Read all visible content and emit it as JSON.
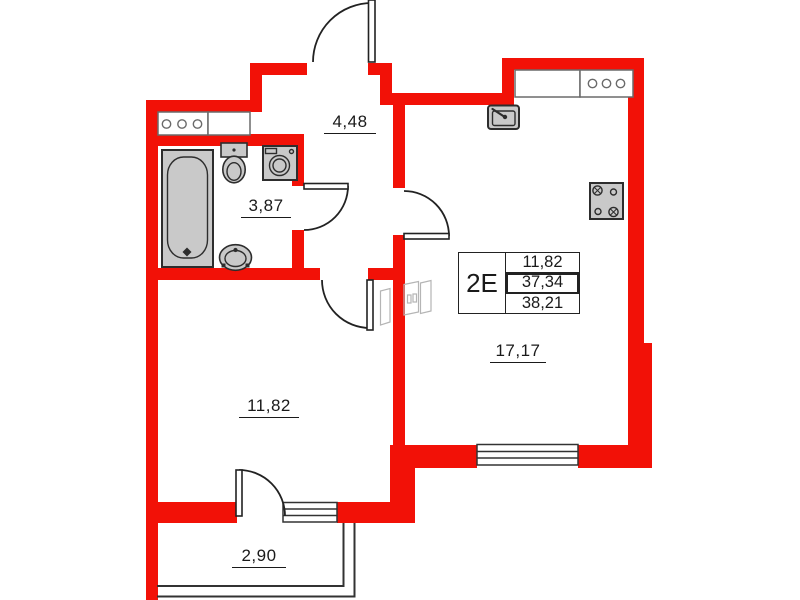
{
  "unit_card": {
    "unit_label": "2Е",
    "values": [
      "11,82",
      "37,34",
      "38,21"
    ]
  },
  "rooms": {
    "hallway": {
      "area": "4,48"
    },
    "bathroom": {
      "area": "3,87"
    },
    "bedroom": {
      "area": "11,82"
    },
    "living_kitchen": {
      "area": "17,17"
    },
    "balcony": {
      "area": "2,90"
    }
  },
  "colors": {
    "wall": "#f21107",
    "fixture_fill": "#c9c9c9",
    "fixture_stroke": "#2d2d2d",
    "line": "#222222",
    "window_line": "#333333",
    "sketch": "#b5b5b5"
  },
  "icons": [
    "bathtub-icon",
    "toilet-icon",
    "washing-machine-icon",
    "bath-sink-icon",
    "kitchen-sink-icon",
    "stove-icon",
    "vent-grille-icon",
    "door-arc",
    "window-symbol",
    "wardrobe-sketch-icon"
  ]
}
